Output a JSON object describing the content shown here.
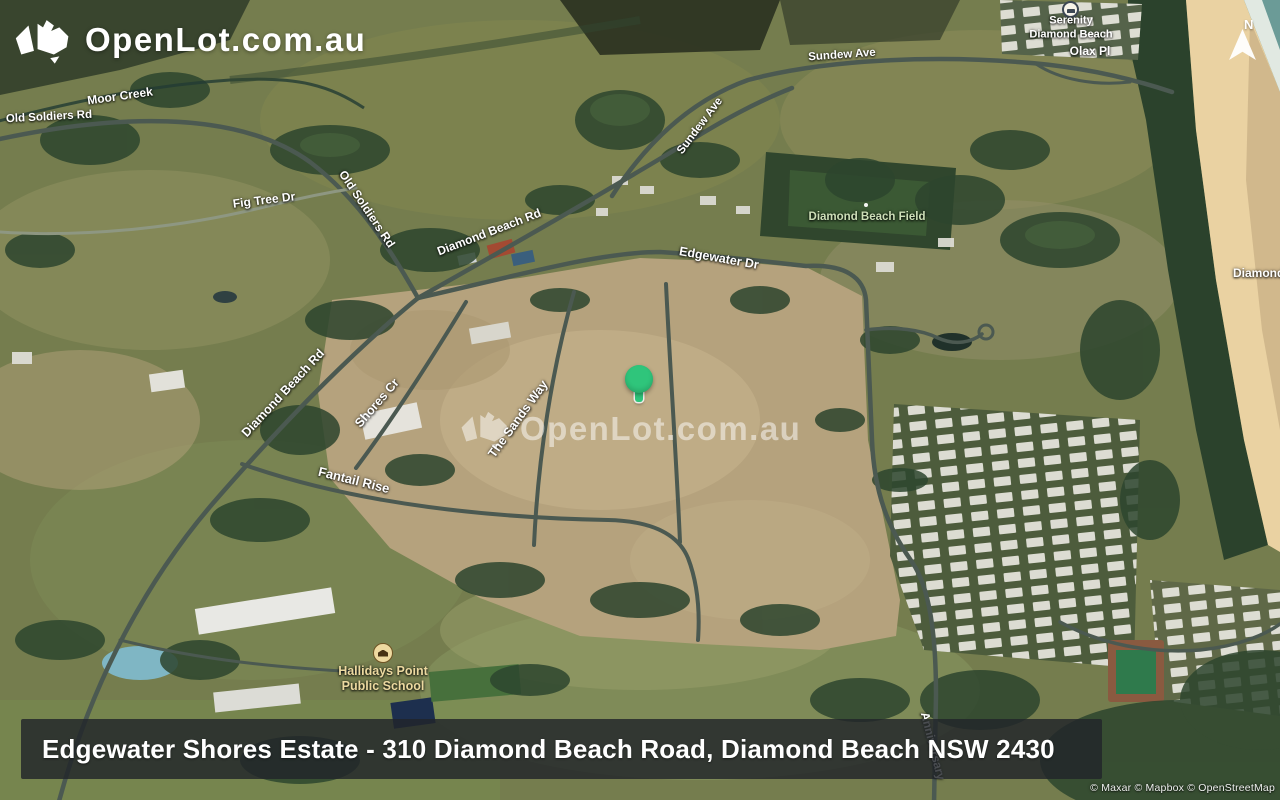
{
  "branding": {
    "logo_text": "OpenLot.com.au",
    "watermark_text": "OpenLot.com.au"
  },
  "compass": {
    "label": "N"
  },
  "marker": {
    "color": "#2fc57b"
  },
  "banner": {
    "text": "Edgewater Shores Estate - 310 Diamond Beach Road, Diamond Beach NSW 2430",
    "bg_color": "#212529"
  },
  "attribution": {
    "text": "© Maxar © Mapbox © OpenStreetMap"
  },
  "map": {
    "label_colors": {
      "road": "#ffffff",
      "park": "#cddfb8",
      "school": "#ecd9a0",
      "poi": "#ffffff"
    },
    "labels": [
      {
        "kind": "creek",
        "text": "Moor Creek"
      },
      {
        "kind": "road",
        "text": "Old Soldiers Rd"
      },
      {
        "kind": "road",
        "text": "Fig Tree Dr"
      },
      {
        "kind": "road",
        "text": "Old Soldiers Rd"
      },
      {
        "kind": "road",
        "text": "Diamond Beach Rd"
      },
      {
        "kind": "road",
        "text": "Sundew Ave"
      },
      {
        "kind": "road",
        "text": "Sundew Ave"
      },
      {
        "kind": "road",
        "text": "Edgewater Dr"
      },
      {
        "kind": "park",
        "text": "Diamond Beach Field"
      },
      {
        "kind": "road",
        "text": "Diamond Beach Rd"
      },
      {
        "kind": "road",
        "text": "Shores Cr"
      },
      {
        "kind": "road",
        "text": "The Sands Way"
      },
      {
        "kind": "road",
        "text": "Fantail Rise"
      },
      {
        "kind": "school",
        "text": "Hallidays Point",
        "text2": "Public School"
      },
      {
        "kind": "poi",
        "text": "Serenity",
        "text2": "Diamond Beach"
      },
      {
        "kind": "road",
        "text": "Olax Pl"
      },
      {
        "kind": "locality",
        "text": "Diamond"
      },
      {
        "kind": "road",
        "text": "Anniversary"
      }
    ]
  }
}
